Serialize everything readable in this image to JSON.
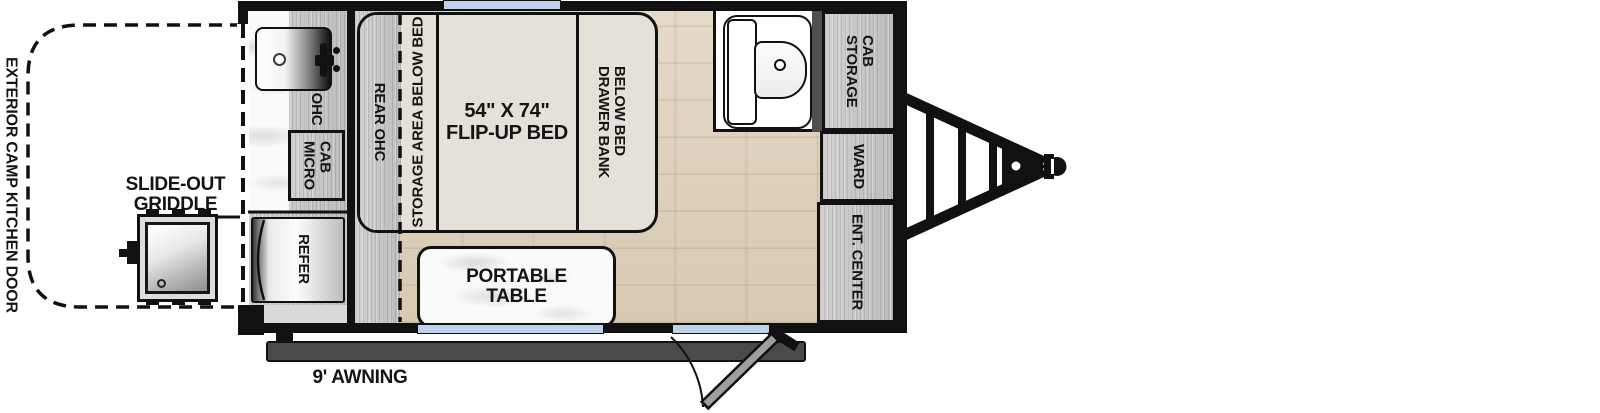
{
  "title": "Travel trailer floorplan",
  "exterior": {
    "camp_kitchen_door_label": "EXTERIOR CAMP KITCHEN DOOR",
    "griddle_label_lines": [
      "SLIDE-OUT",
      "GRIDDLE"
    ],
    "awning_label": "9' AWNING"
  },
  "interior": {
    "ohc_label": "OHC",
    "micro_cab_lines": [
      "MICRO",
      "CAB"
    ],
    "refer_label": "REFER",
    "rear_ohc_label": "REAR OHC",
    "storage_below_bed_label": "STORAGE AREA BELOW BED",
    "bed_label_lines": [
      "54\" X 74\"",
      "FLIP-UP BED"
    ],
    "drawer_bank_lines": [
      "DRAWER BANK",
      "BELOW BED"
    ],
    "portable_table_lines": [
      "PORTABLE",
      "TABLE"
    ],
    "storage_cab_lines": [
      "STORAGE",
      "CAB"
    ],
    "ward_label": "WARD",
    "ent_center_label": "ENT. CENTER"
  },
  "colors": {
    "wall": "#111111",
    "wood_cabinet": "#c9c8c6",
    "floor_wood": "#ded2c0",
    "bed_beige": "#e6e1d8",
    "window_blue": "#bed3ea",
    "awning_gray": "#4a4a4a",
    "partition_gray": "#4f4f4f"
  }
}
